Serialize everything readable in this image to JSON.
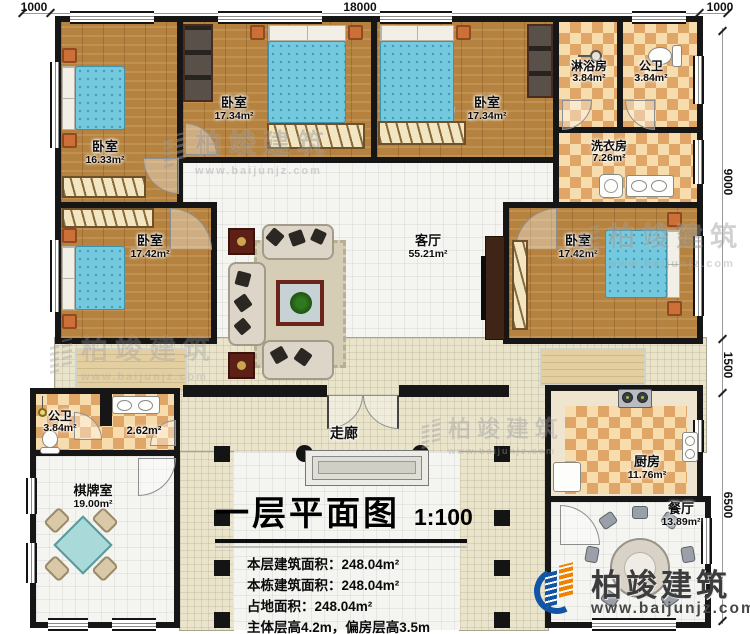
{
  "dimensions": {
    "top": [
      "1000",
      "18000",
      "1000"
    ],
    "right": [
      "9000",
      "1500",
      "6500"
    ]
  },
  "rooms": {
    "bedroom_tl": {
      "name": "卧室",
      "area": "16.33m²"
    },
    "bedroom_tm": {
      "name": "卧室",
      "area": "17.34m²"
    },
    "bedroom_tr": {
      "name": "卧室",
      "area": "17.34m²"
    },
    "shower_room": {
      "name": "淋浴房",
      "area": "3.84m²"
    },
    "bath_top": {
      "name": "公卫",
      "area": "3.84m²"
    },
    "laundry": {
      "name": "洗衣房",
      "area": "7.26m²"
    },
    "bedroom_ml": {
      "name": "卧室",
      "area": "17.42m²"
    },
    "living": {
      "name": "客厅",
      "area": "55.21m²"
    },
    "bedroom_mr": {
      "name": "卧室",
      "area": "17.42m²"
    },
    "bath_left": {
      "name": "公卫",
      "area": "3.84m²"
    },
    "washroom": {
      "area": "2.62m²"
    },
    "chess_room": {
      "name": "棋牌室",
      "area": "19.00m²"
    },
    "corridor": {
      "name": "走廊"
    },
    "kitchen": {
      "name": "厨房",
      "area": "11.76m²"
    },
    "dining": {
      "name": "餐厅",
      "area": "13.89m²"
    }
  },
  "title_block": {
    "title": "一层平面图",
    "scale": "1:100",
    "stats": [
      "本层建筑面积：248.04m²",
      "本栋建筑面积：248.04m²",
      "占地面积：248.04m²",
      "主体层高4.2m，偏房层高3.5m"
    ]
  },
  "brand": {
    "name": "柏竣建筑",
    "url": "www.baijunjz.com"
  },
  "colors": {
    "wall": "#161616",
    "wood_floor": "#b5823f",
    "tile_light": "#f7ddae",
    "tile_dark": "#e0a668",
    "bed_blue": "#74c9de",
    "logo_blue": "#1155a4",
    "logo_orange": "#ef8200"
  }
}
